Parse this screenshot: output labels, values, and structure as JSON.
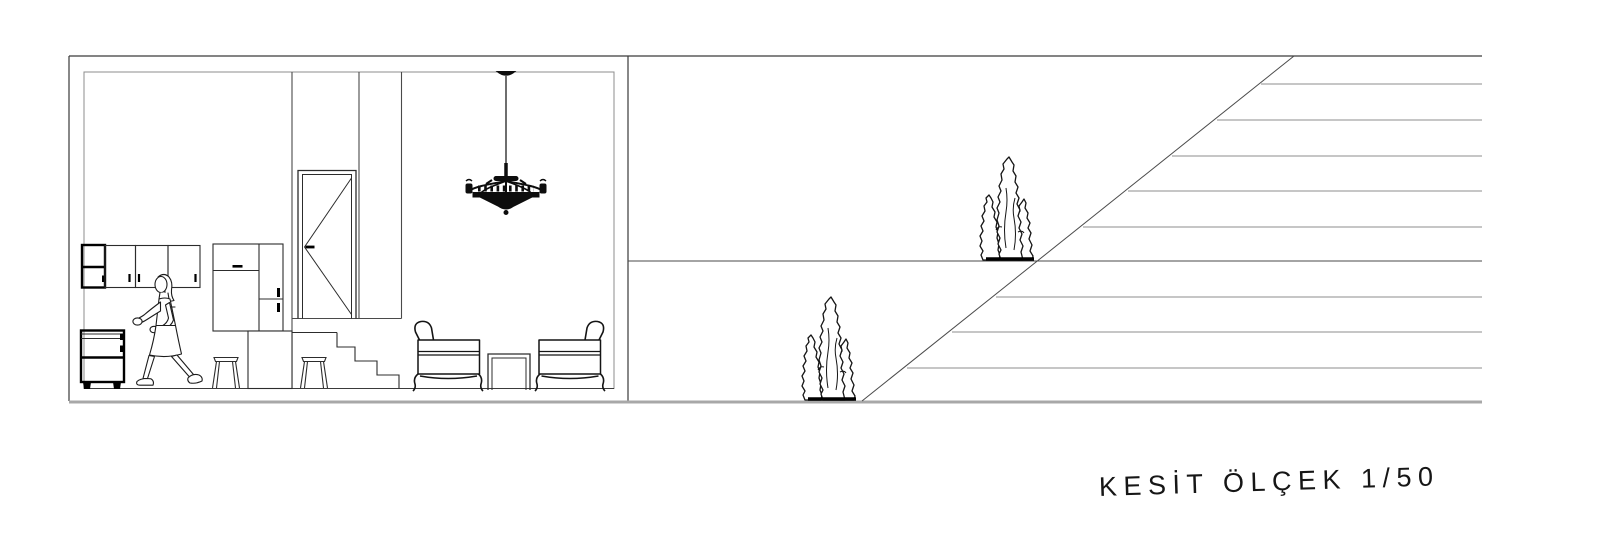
{
  "drawing": {
    "caption": "KESİT ÖLÇEK 1/50"
  },
  "colors": {
    "background": "#ffffff",
    "line_primary": "#3a3a3a",
    "line_secondary": "#8c8c8c",
    "ground_line": "#a8a8a8",
    "ink": "#141414"
  },
  "icons": {
    "woman": "walking-woman-figure",
    "chandelier": "chandelier",
    "tree_upper": "cypress-tree",
    "tree_lower": "cypress-tree",
    "door": "interior-door-elevation",
    "stairs": "stairs",
    "wall_cabinets": "kitchen-wall-cabinets",
    "base_cabinet": "kitchen-base-cabinet",
    "tall_cabinet": "tall-cabinet",
    "island": "kitchen-island-counter",
    "stools": "bar-stools",
    "armchairs": "armchairs",
    "side_table": "side-table",
    "slope_hatch": "terrain-slope-hatch"
  }
}
